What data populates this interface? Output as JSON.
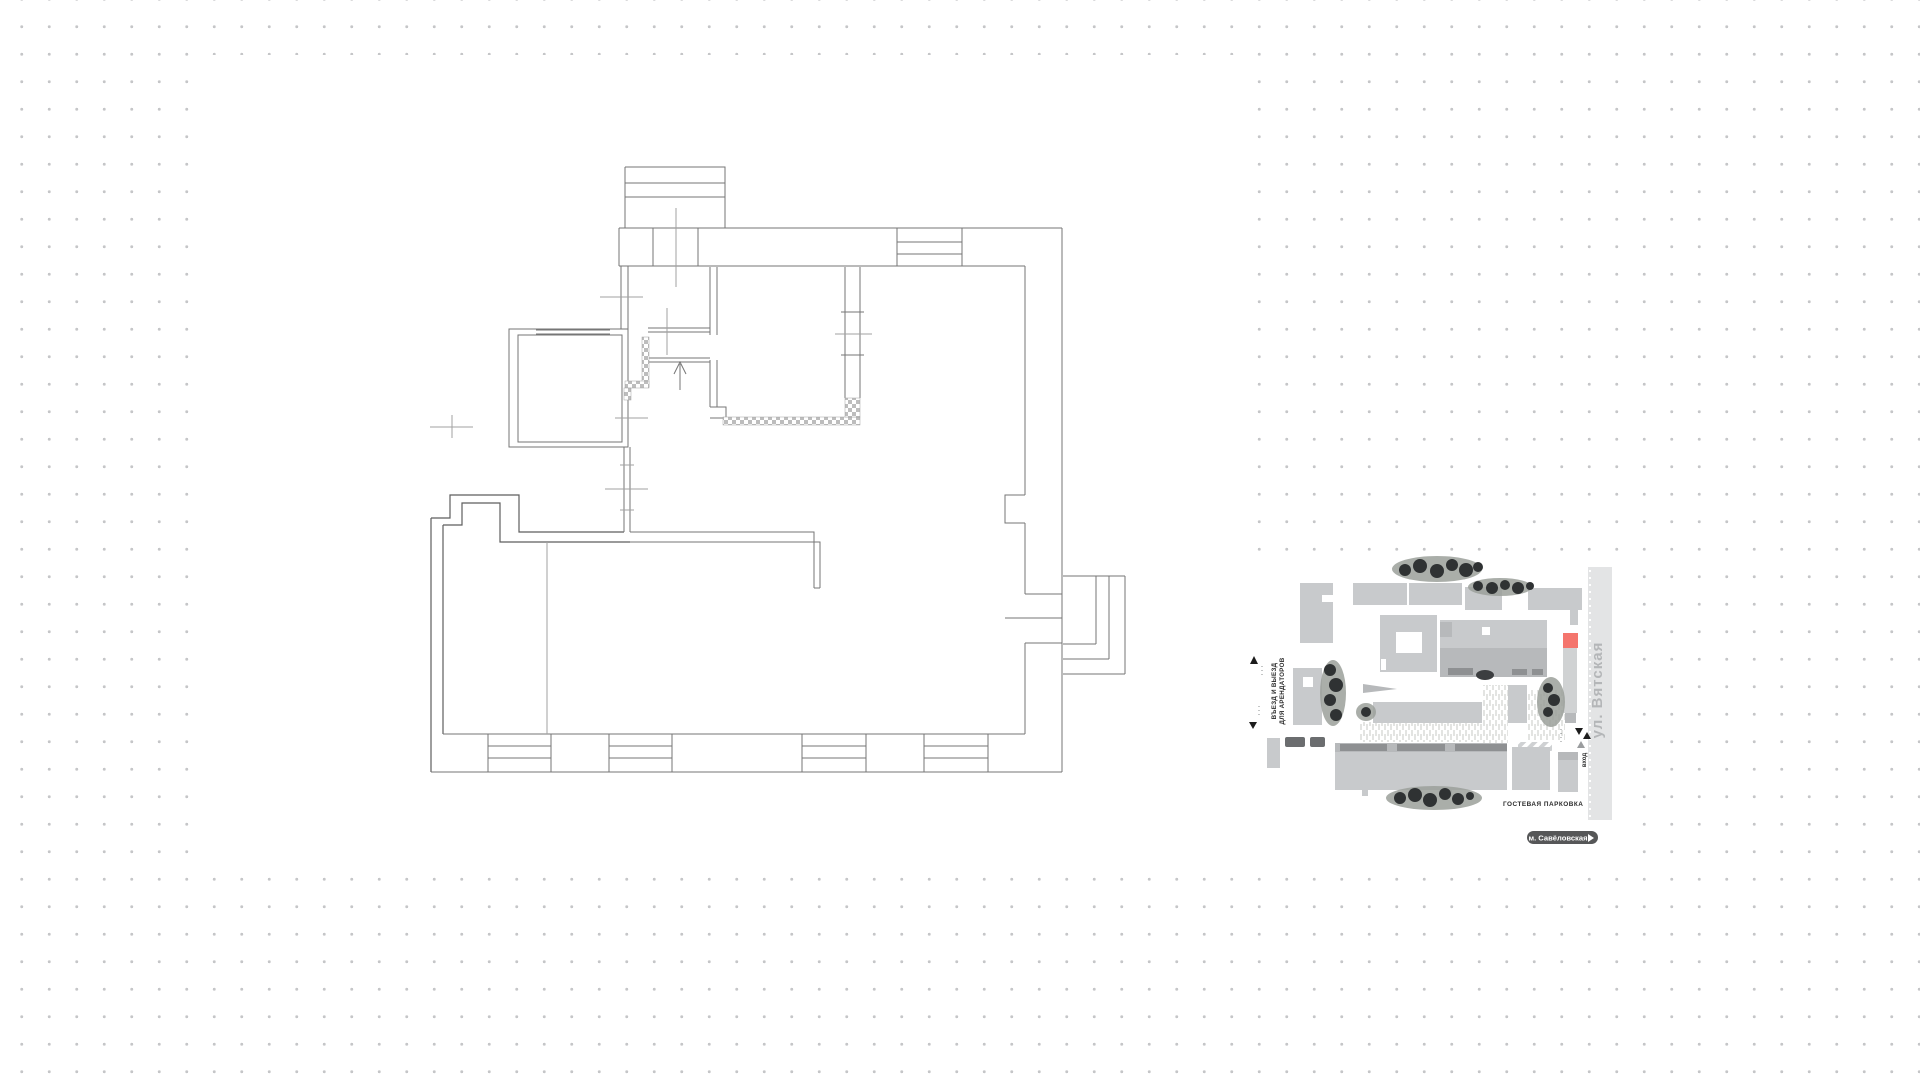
{
  "colors": {
    "bg": "#ffffff",
    "dot": "#c5c6c8",
    "plan_line": "#767676",
    "plan_line_dark": "#5e5e5e",
    "plan_line_light": "#a2a2a2",
    "building": "#c8cacc",
    "building_mid": "#b7b9bb",
    "building_dark": "#8e9092",
    "road": "#e3e4e5",
    "street_text": "#b4b6b8",
    "accent_red": "#f4756d",
    "tree_dark": "#2f3233",
    "tree_soft": "#9ba09a",
    "label_text": "#2b2b2b",
    "pill_bg": "#565758",
    "pill_text": "#ffffff"
  },
  "site_plan": {
    "labels": {
      "street": "ул. Вятская",
      "tenant_gate_line1": "ВЪЕЗД И ВЫЕЗД",
      "tenant_gate_line2": "ДЛЯ АРЕНДАТОРОВ",
      "entrance": "вход",
      "guest_parking": "ГОСТЕВАЯ ПАРКОВКА",
      "metro_station": "м. Савёловская"
    },
    "markers": {
      "gate_in_icon": "triangle-up",
      "gate_out_icon": "triangle-down",
      "entrance_icons": "triangle-pair",
      "metro_pill_icon": "arrow-southeast"
    }
  }
}
